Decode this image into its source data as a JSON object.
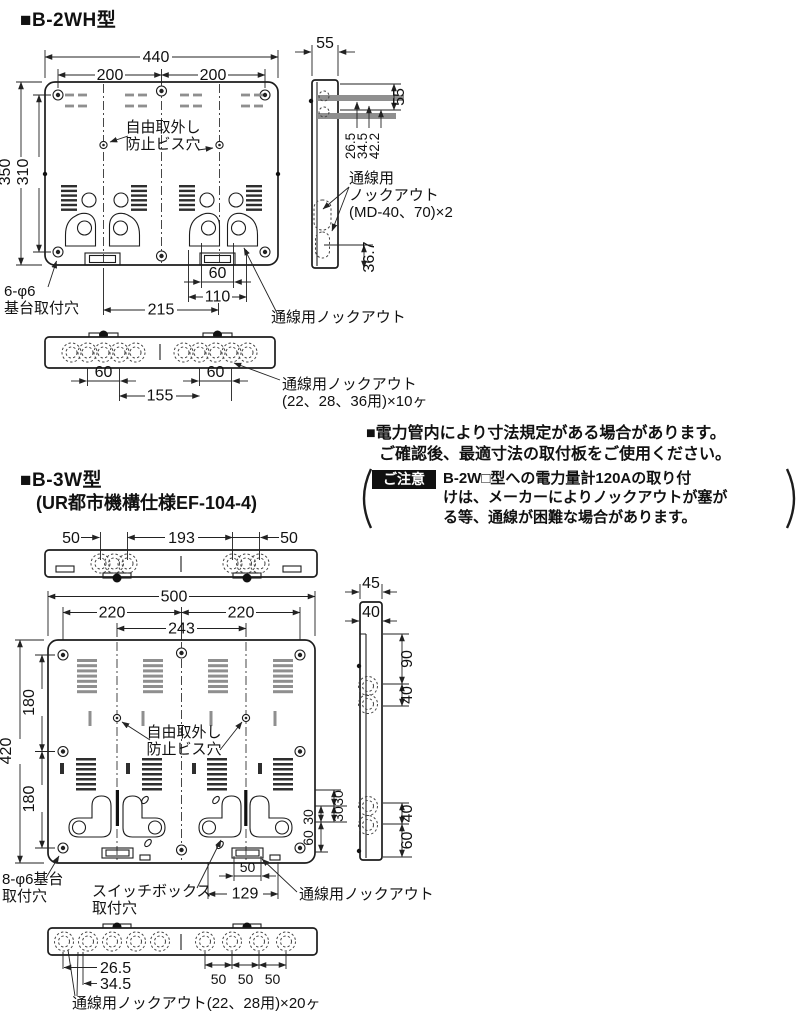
{
  "colors": {
    "ink": "#1c1c1c",
    "gray": "#8f8f8f",
    "bg": "#ffffff",
    "caution_bg": "#101010",
    "caution_fg": "#ffffff"
  },
  "s1": {
    "title": "■B-2WH型",
    "front": {
      "d440": "440",
      "d200a": "200",
      "d200b": "200",
      "d350": "350",
      "d310": "310",
      "bis1": "自由取外し",
      "bis2": "防止ビス穴",
      "base1": "6-φ6",
      "base2": "基台取付穴",
      "d60": "60",
      "d110": "110",
      "d215": "215",
      "ko": "通線用ノックアウト"
    },
    "side": {
      "dw": "55",
      "d55": "55",
      "d265": "26.5",
      "d345": "34.5",
      "d422": "42.2",
      "d367": "36.7",
      "ko1": "通線用",
      "ko2": "ノックアウト",
      "ko3": "(MD-40、70)×2"
    },
    "strip": {
      "d60a": "60",
      "d155": "155",
      "d60b": "60",
      "ko1": "通線用ノックアウト",
      "ko2": "(22、28、36用)×10ヶ"
    }
  },
  "notes": {
    "l1": "■電力管内により寸法規定がある場合があります。",
    "l2": "ご確認後、最適寸法の取付板をご使用ください。",
    "caution_label": "ご注意",
    "c1": "B-2W□型への電力量計120Aの取り付",
    "c2": "けは、メーカーによりノックアウトが塞が",
    "c3": "る等、通線が困難な場合があります。"
  },
  "s2": {
    "title": "■B-3W型",
    "subtitle": "(UR都市機構仕様EF-104-4)",
    "top": {
      "d50a": "50",
      "d193": "193",
      "d50b": "50"
    },
    "front": {
      "d500": "500",
      "d220a": "220",
      "d220b": "220",
      "d243": "243",
      "d420": "420",
      "d180a": "180",
      "d180b": "180",
      "bis1": "自由取外し",
      "bis2": "防止ビス穴",
      "r30a": "30",
      "r30b": "30",
      "r30c": "30",
      "r60": "60",
      "d50": "50",
      "d129": "129",
      "base1": "8-φ6基台",
      "base2": "取付穴",
      "sw1": "スイッチボックス",
      "sw2": "取付穴",
      "ko": "通線用ノックアウト"
    },
    "side": {
      "d45": "45",
      "d40t": "40",
      "d90": "90",
      "d40a": "40",
      "d40b": "40",
      "d60": "60"
    },
    "strip": {
      "d265": "26.5",
      "d345": "34.5",
      "d50a": "50",
      "d50b": "50",
      "d50c": "50",
      "ko": "通線用ノックアウト(22、28用)×20ヶ"
    }
  }
}
